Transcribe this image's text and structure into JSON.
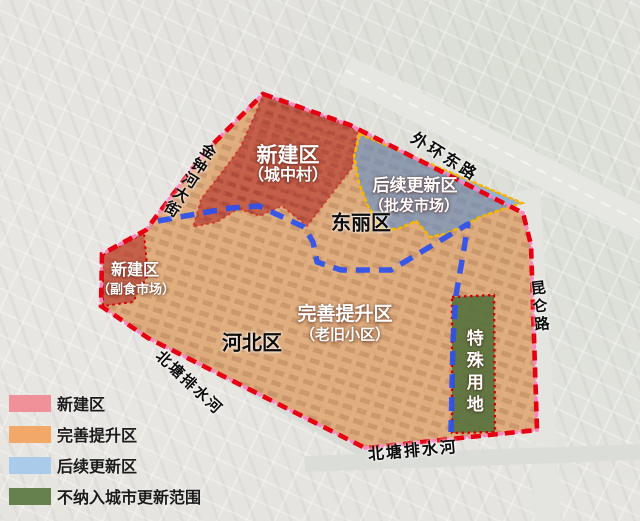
{
  "map": {
    "zones": {
      "xinjian_chengzhongcun": {
        "name": "新建区",
        "sub": "（城中村）"
      },
      "xinjian_fushi": {
        "name": "新建区",
        "sub": "（副食市场）"
      },
      "houxu": {
        "name": "后续更新区",
        "sub": "（批发市场）"
      },
      "wanshan": {
        "name": "完善提升区",
        "sub": "（老旧小区）"
      },
      "teshu": {
        "name": "特殊用地"
      }
    },
    "districts": {
      "dongli": "东丽区",
      "hebei": "河北区"
    },
    "roads": {
      "waihuan": "外环东路",
      "jinzhonghe": "金钟河大街",
      "kunlun": "昆仑路"
    },
    "rivers": {
      "beitang_left": "北塘排水河",
      "beitang_bottom": "北塘排水河"
    }
  },
  "legend": {
    "items": [
      {
        "label": "新建区",
        "color": "#f0919a"
      },
      {
        "label": "完善提升区",
        "color": "#f1a869"
      },
      {
        "label": "后续更新区",
        "color": "#abcbea"
      },
      {
        "label": "不纳入城市更新范围",
        "color": "#67814e"
      }
    ]
  },
  "colors": {
    "boundary_red": "#e60012",
    "boundary_pink": "#ff85c2",
    "zone_red": "#b5302c",
    "zone_orange": "#dd9758",
    "zone_blue": "#5b8fd0",
    "zone_green": "#55713d",
    "district_line_blue": "#2b50f0",
    "zone_border_yellow": "#f7b500",
    "zone_border_red": "#d40000"
  }
}
